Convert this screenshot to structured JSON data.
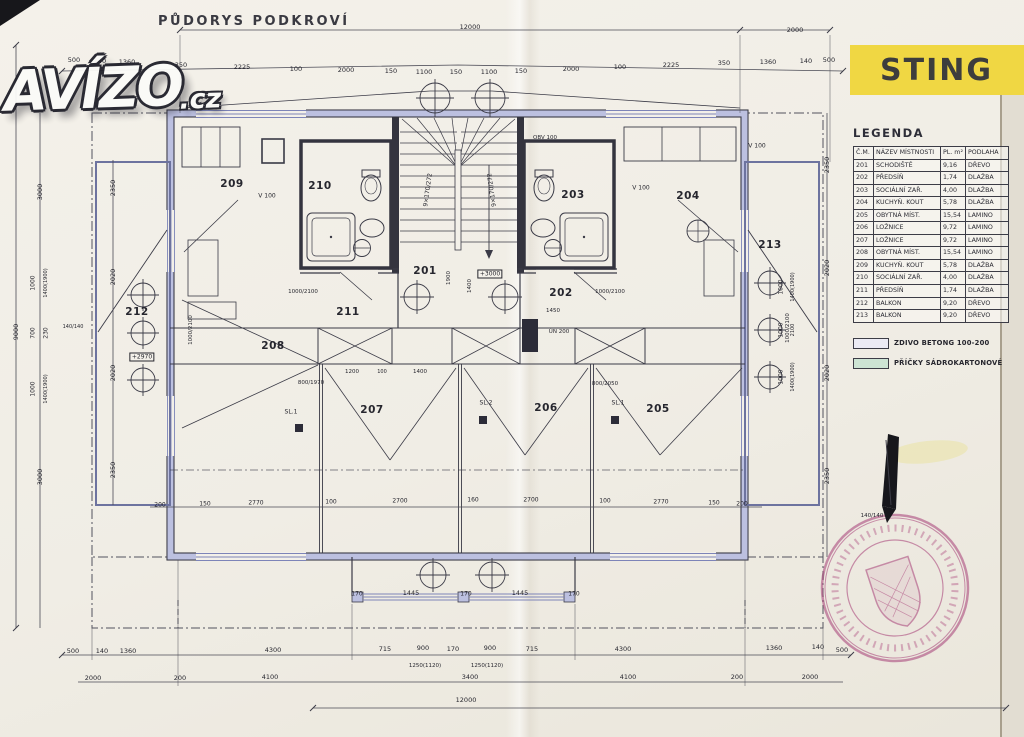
{
  "watermark": {
    "brand": "AVÍZO",
    "tld": ".cz"
  },
  "drawing_title": "PŮDORYS PODKROVÍ",
  "badge": {
    "label": "STING",
    "bg": "#f0d743",
    "fg": "#3d3d3d"
  },
  "legend": {
    "title": "LEGENDA",
    "table": {
      "headers": [
        "Č.M.",
        "NÁZEV MÍSTNOSTI",
        "PL. m²",
        "PODLAHA"
      ],
      "rows": [
        [
          "201",
          "SCHODIŠTĚ",
          "9,16",
          "DŘEVO"
        ],
        [
          "202",
          "PŘEDSÍŇ",
          "1,74",
          "DLAŽBA"
        ],
        [
          "203",
          "SOCIÁLNÍ ZAŘ.",
          "4,00",
          "DLAŽBA"
        ],
        [
          "204",
          "KUCHYŇ. KOUT",
          "5,78",
          "DLAŽBA"
        ],
        [
          "205",
          "OBYTNÁ MÍST.",
          "15,54",
          "LAMINO"
        ],
        [
          "206",
          "LOŽNICE",
          "9,72",
          "LAMINO"
        ],
        [
          "207",
          "LOŽNICE",
          "9,72",
          "LAMINO"
        ],
        [
          "208",
          "OBYTNÁ MÍST.",
          "15,54",
          "LAMINO"
        ],
        [
          "209",
          "KUCHYŇ. KOUT",
          "5,78",
          "DLAŽBA"
        ],
        [
          "210",
          "SOCIÁLNÍ ZAŘ.",
          "4,00",
          "DLAŽBA"
        ],
        [
          "211",
          "PŘEDSÍŇ",
          "1,74",
          "DLAŽBA"
        ],
        [
          "212",
          "BALKON",
          "9,20",
          "DŘEVO"
        ],
        [
          "213",
          "BALKON",
          "9,20",
          "DŘEVO"
        ]
      ]
    },
    "materials": [
      {
        "label": "ZDIVO BETONG 100-200",
        "swatch": "#ecebf4"
      },
      {
        "label": "PŘÍČKY SÁDROKARTONOVÉ",
        "swatch": "#cde4d4"
      }
    ]
  },
  "plan": {
    "rooms": [
      {
        "t": "209",
        "x": 232,
        "y": 184
      },
      {
        "t": "210",
        "x": 320,
        "y": 186
      },
      {
        "t": "203",
        "x": 573,
        "y": 195
      },
      {
        "t": "204",
        "x": 688,
        "y": 196
      },
      {
        "t": "201",
        "x": 425,
        "y": 271
      },
      {
        "t": "202",
        "x": 561,
        "y": 293
      },
      {
        "t": "211",
        "x": 348,
        "y": 312
      },
      {
        "t": "212",
        "x": 137,
        "y": 312
      },
      {
        "t": "213",
        "x": 770,
        "y": 245
      },
      {
        "t": "208",
        "x": 273,
        "y": 346
      },
      {
        "t": "207",
        "x": 372,
        "y": 410
      },
      {
        "t": "206",
        "x": 546,
        "y": 408
      },
      {
        "t": "205",
        "x": 658,
        "y": 409
      }
    ],
    "dims": [
      {
        "t": "12000",
        "x": 470,
        "y": 27
      },
      {
        "t": "2000",
        "x": 795,
        "y": 30
      },
      {
        "t": "500",
        "x": 74,
        "y": 60
      },
      {
        "t": "140",
        "x": 100,
        "y": 61
      },
      {
        "t": "1360",
        "x": 127,
        "y": 62
      },
      {
        "t": "350",
        "x": 181,
        "y": 65
      },
      {
        "t": "2225",
        "x": 242,
        "y": 67
      },
      {
        "t": "100",
        "x": 296,
        "y": 69
      },
      {
        "t": "2000",
        "x": 346,
        "y": 70
      },
      {
        "t": "150",
        "x": 391,
        "y": 71
      },
      {
        "t": "1100",
        "x": 424,
        "y": 72
      },
      {
        "t": "150",
        "x": 456,
        "y": 72
      },
      {
        "t": "1100",
        "x": 489,
        "y": 72
      },
      {
        "t": "150",
        "x": 521,
        "y": 71
      },
      {
        "t": "2000",
        "x": 571,
        "y": 69
      },
      {
        "t": "100",
        "x": 620,
        "y": 67
      },
      {
        "t": "2225",
        "x": 671,
        "y": 65
      },
      {
        "t": "350",
        "x": 724,
        "y": 63
      },
      {
        "t": "1360",
        "x": 768,
        "y": 62
      },
      {
        "t": "140",
        "x": 806,
        "y": 61
      },
      {
        "t": "500",
        "x": 829,
        "y": 60
      },
      {
        "t": "9000",
        "x": 16,
        "y": 332,
        "r": -90
      },
      {
        "t": "3000",
        "x": 40,
        "y": 192,
        "r": -90
      },
      {
        "t": "1000",
        "x": 33,
        "y": 283,
        "r": -90,
        "s": 6
      },
      {
        "t": "1400(1900)",
        "x": 46,
        "y": 283,
        "r": -90,
        "s": 5
      },
      {
        "t": "700",
        "x": 33,
        "y": 333,
        "r": -90,
        "s": 6
      },
      {
        "t": "230",
        "x": 46,
        "y": 333,
        "r": -90,
        "s": 6
      },
      {
        "t": "1000",
        "x": 33,
        "y": 389,
        "r": -90,
        "s": 6
      },
      {
        "t": "1400(1900)",
        "x": 46,
        "y": 389,
        "r": -90,
        "s": 5
      },
      {
        "t": "3000",
        "x": 40,
        "y": 477,
        "r": -90
      },
      {
        "t": "2350",
        "x": 113,
        "y": 188,
        "r": -90
      },
      {
        "t": "2020",
        "x": 113,
        "y": 277,
        "r": -90
      },
      {
        "t": "2020",
        "x": 113,
        "y": 373,
        "r": -90
      },
      {
        "t": "2350",
        "x": 113,
        "y": 470,
        "r": -90
      },
      {
        "t": "140/140",
        "x": 73,
        "y": 327,
        "s": 5
      },
      {
        "t": "2350",
        "x": 827,
        "y": 165,
        "r": -90
      },
      {
        "t": "2020",
        "x": 827,
        "y": 268,
        "r": -90
      },
      {
        "t": "2020",
        "x": 827,
        "y": 373,
        "r": -90
      },
      {
        "t": "2350",
        "x": 827,
        "y": 476,
        "r": -90
      },
      {
        "t": "1000",
        "x": 781,
        "y": 287,
        "r": -90,
        "s": 6
      },
      {
        "t": "1400(1900)",
        "x": 793,
        "y": 287,
        "r": -90,
        "s": 5
      },
      {
        "t": "1000",
        "x": 781,
        "y": 330,
        "r": -90,
        "s": 6
      },
      {
        "t": "2100",
        "x": 793,
        "y": 330,
        "r": -90,
        "s": 5
      },
      {
        "t": "1000",
        "x": 781,
        "y": 377,
        "r": -90,
        "s": 6
      },
      {
        "t": "1400(1900)",
        "x": 793,
        "y": 377,
        "r": -90,
        "s": 5
      },
      {
        "t": "140/140",
        "x": 872,
        "y": 516,
        "s": 5.5
      },
      {
        "t": "200",
        "x": 160,
        "y": 505,
        "s": 6
      },
      {
        "t": "150",
        "x": 205,
        "y": 504,
        "s": 6
      },
      {
        "t": "2770",
        "x": 256,
        "y": 503,
        "s": 6
      },
      {
        "t": "100",
        "x": 331,
        "y": 502,
        "s": 6
      },
      {
        "t": "2700",
        "x": 400,
        "y": 501,
        "s": 6
      },
      {
        "t": "160",
        "x": 473,
        "y": 500,
        "s": 6
      },
      {
        "t": "2700",
        "x": 531,
        "y": 500,
        "s": 6
      },
      {
        "t": "100",
        "x": 605,
        "y": 501,
        "s": 6
      },
      {
        "t": "2770",
        "x": 661,
        "y": 502,
        "s": 6
      },
      {
        "t": "150",
        "x": 714,
        "y": 503,
        "s": 6
      },
      {
        "t": "200",
        "x": 742,
        "y": 504,
        "s": 6
      },
      {
        "t": "170",
        "x": 357,
        "y": 594,
        "s": 6
      },
      {
        "t": "1445",
        "x": 411,
        "y": 593
      },
      {
        "t": "170",
        "x": 466,
        "y": 594,
        "s": 6
      },
      {
        "t": "1445",
        "x": 520,
        "y": 593
      },
      {
        "t": "170",
        "x": 574,
        "y": 594,
        "s": 6
      },
      {
        "t": "500",
        "x": 73,
        "y": 651
      },
      {
        "t": "140",
        "x": 102,
        "y": 651
      },
      {
        "t": "1360",
        "x": 128,
        "y": 651
      },
      {
        "t": "4300",
        "x": 273,
        "y": 650
      },
      {
        "t": "715",
        "x": 385,
        "y": 649
      },
      {
        "t": "900",
        "x": 423,
        "y": 648
      },
      {
        "t": "170",
        "x": 453,
        "y": 649
      },
      {
        "t": "900",
        "x": 490,
        "y": 648
      },
      {
        "t": "715",
        "x": 532,
        "y": 649
      },
      {
        "t": "4300",
        "x": 623,
        "y": 649
      },
      {
        "t": "1360",
        "x": 774,
        "y": 648
      },
      {
        "t": "140",
        "x": 818,
        "y": 647
      },
      {
        "t": "500",
        "x": 842,
        "y": 650
      },
      {
        "t": "1250(1120)",
        "x": 425,
        "y": 666,
        "s": 5.5
      },
      {
        "t": "1250(1120)",
        "x": 487,
        "y": 666,
        "s": 5.5
      },
      {
        "t": "2000",
        "x": 93,
        "y": 678
      },
      {
        "t": "200",
        "x": 180,
        "y": 678
      },
      {
        "t": "4100",
        "x": 270,
        "y": 677
      },
      {
        "t": "3400",
        "x": 470,
        "y": 677
      },
      {
        "t": "4100",
        "x": 628,
        "y": 677
      },
      {
        "t": "200",
        "x": 737,
        "y": 677
      },
      {
        "t": "2000",
        "x": 810,
        "y": 677
      },
      {
        "t": "12000",
        "x": 466,
        "y": 700
      }
    ],
    "notes": [
      {
        "t": "V 100",
        "x": 267,
        "y": 196
      },
      {
        "t": "V 100",
        "x": 641,
        "y": 188
      },
      {
        "t": "V 100",
        "x": 757,
        "y": 146
      },
      {
        "t": "OBV 100",
        "x": 545,
        "y": 138,
        "s": 5.5
      },
      {
        "t": "ÚN 200",
        "x": 559,
        "y": 332,
        "s": 5.5
      },
      {
        "t": "+2970",
        "x": 142,
        "y": 357,
        "box": true
      },
      {
        "t": "+3000",
        "x": 490,
        "y": 274,
        "box": true
      },
      {
        "t": "SL.1",
        "x": 291,
        "y": 412
      },
      {
        "t": "SL.2",
        "x": 486,
        "y": 403
      },
      {
        "t": "SL.1",
        "x": 618,
        "y": 403
      },
      {
        "t": "9×170/272",
        "x": 428,
        "y": 190,
        "r": -82
      },
      {
        "t": "9×170/272",
        "x": 492,
        "y": 190,
        "r": -98
      },
      {
        "t": "1000/2100",
        "x": 303,
        "y": 292,
        "s": 5.5
      },
      {
        "t": "1000/2100",
        "x": 610,
        "y": 292,
        "s": 5.5
      },
      {
        "t": "800/1970",
        "x": 311,
        "y": 383,
        "s": 5.5
      },
      {
        "t": "800/2050",
        "x": 605,
        "y": 384,
        "s": 5.5
      },
      {
        "t": "1000/2100",
        "x": 191,
        "y": 330,
        "s": 5.5,
        "r": -90
      },
      {
        "t": "1000/2100",
        "x": 788,
        "y": 328,
        "s": 5.5,
        "r": -90
      },
      {
        "t": "1450",
        "x": 553,
        "y": 311,
        "s": 5.5
      },
      {
        "t": "1200",
        "x": 352,
        "y": 372,
        "s": 5.5
      },
      {
        "t": "100",
        "x": 382,
        "y": 372,
        "s": 5
      },
      {
        "t": "1400",
        "x": 420,
        "y": 372,
        "s": 5.5
      },
      {
        "t": "1900",
        "x": 449,
        "y": 278,
        "r": -90,
        "s": 5.5
      },
      {
        "t": "1400",
        "x": 470,
        "y": 286,
        "r": -90,
        "s": 5.5
      }
    ]
  }
}
